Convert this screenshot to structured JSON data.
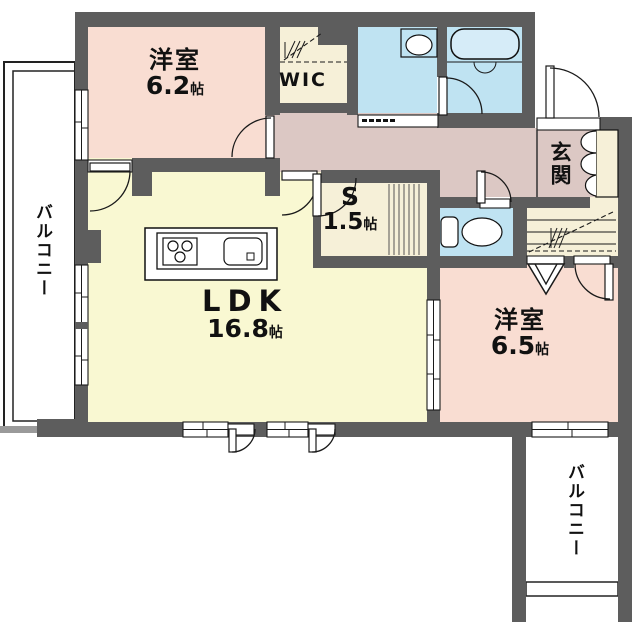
{
  "title": "apartment floor plan",
  "colors": {
    "wall": "#5d5d5d",
    "pink": "#f9ddd2",
    "yellow": "#f9f8d2",
    "cream": "#f6f0d8",
    "blue": "#bfe3f2",
    "mauve": "#dcc8c4",
    "line": "#1a1a1a"
  },
  "rooms": {
    "bedroom1": {
      "name": "洋室",
      "size": "6.2",
      "unit": "帖"
    },
    "wic": {
      "name": "WIC"
    },
    "entrance": {
      "name": "玄関"
    },
    "storage": {
      "name": "S",
      "size": "1.5",
      "unit": "帖"
    },
    "ldk": {
      "name": "LDK",
      "size": "16.8",
      "unit": "帖"
    },
    "bedroom2": {
      "name": "洋室",
      "size": "6.5",
      "unit": "帖"
    },
    "balcony_left": {
      "name": "バルコニー"
    },
    "balcony_bottom": {
      "name": "バルコニー"
    }
  },
  "fixtures": [
    "kitchen-counter",
    "stove",
    "kitchen-sink",
    "bathtub",
    "washbasin",
    "toilet",
    "shoe-cabinet"
  ]
}
